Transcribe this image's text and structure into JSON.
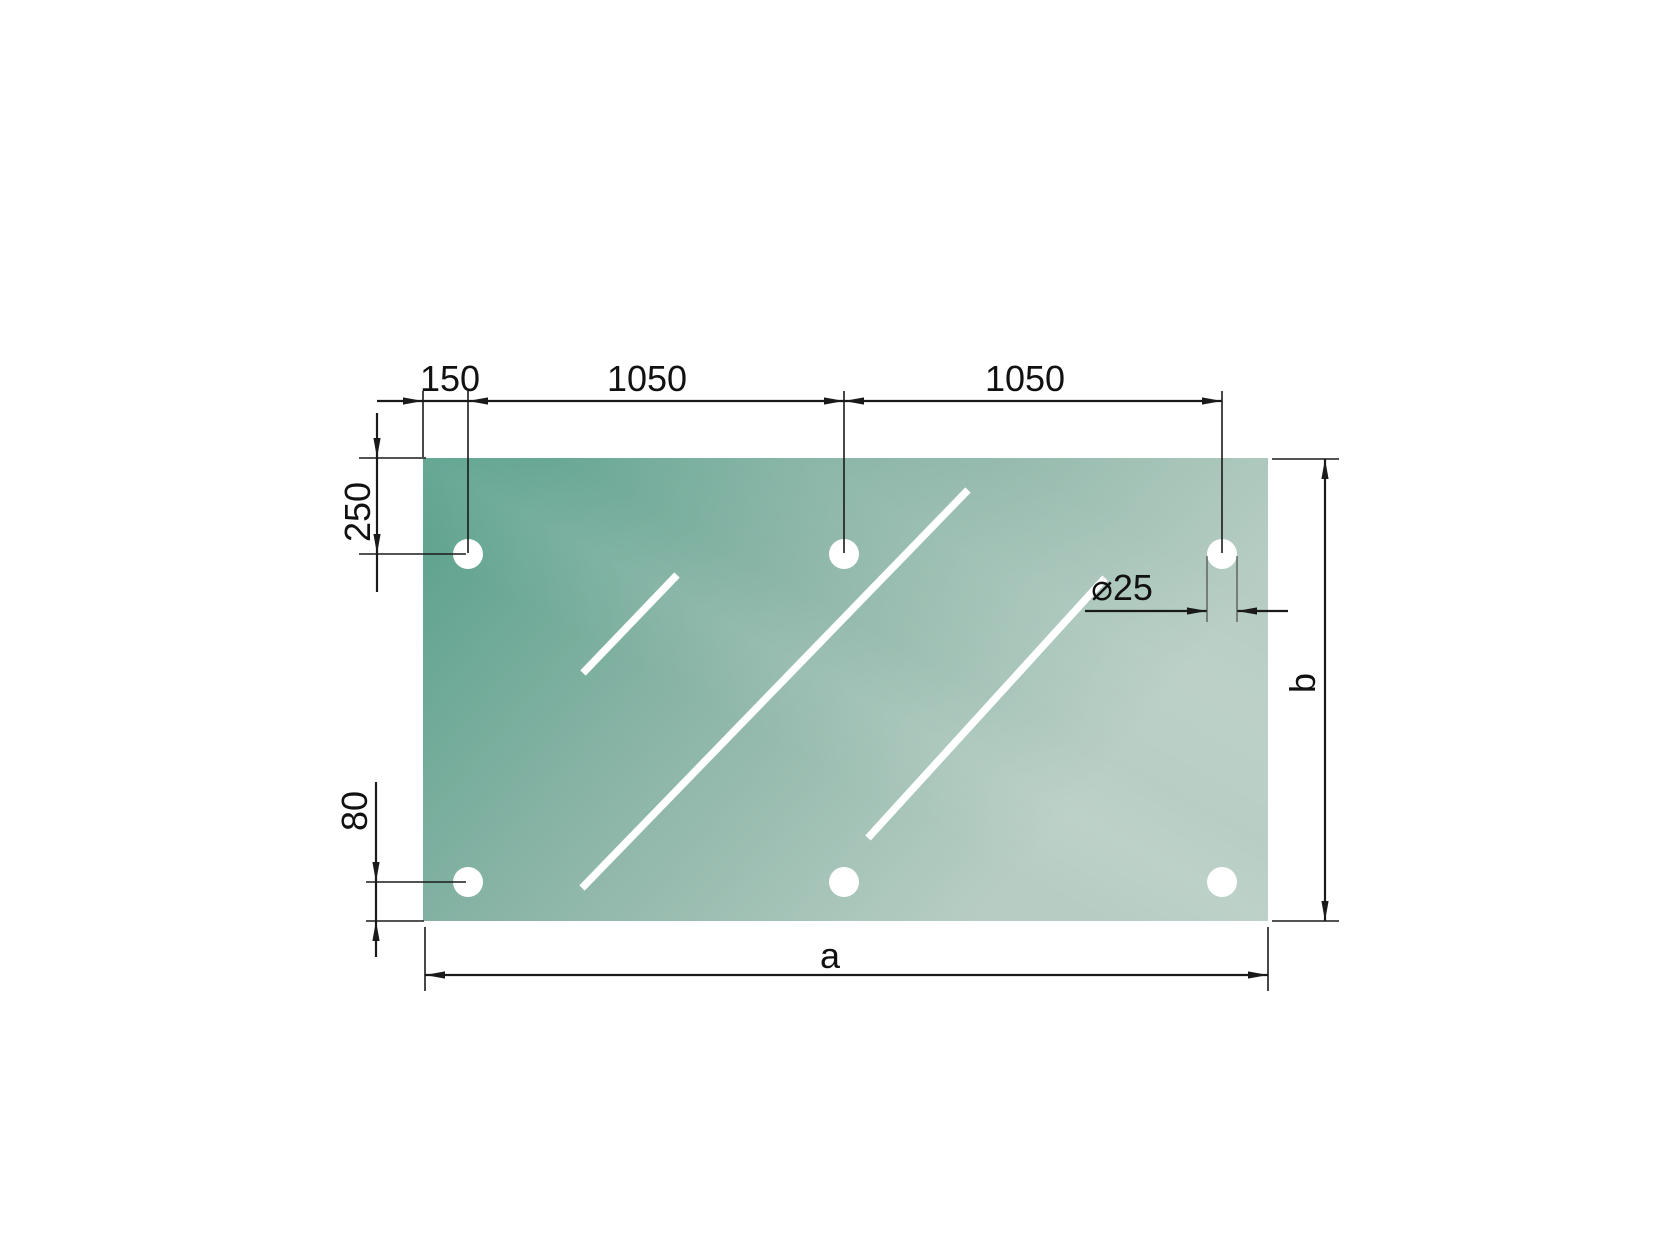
{
  "drawing": {
    "labels": {
      "top_offset": "150",
      "top_span_left": "1050",
      "top_span_right": "1050",
      "side_top_offset": "250",
      "side_bottom_offset": "80",
      "hole_diameter": "⌀25",
      "width_label": "a",
      "height_label": "b"
    },
    "colors": {
      "background": "#ffffff",
      "panel_dark": "#58a08b",
      "panel_mid": "#8bb5a7",
      "panel_light": "#b7cdc3",
      "line": "#1a1a1a",
      "thin_line": "#4a4a4a",
      "text": "#111111",
      "highlight": "#ffffff"
    }
  }
}
